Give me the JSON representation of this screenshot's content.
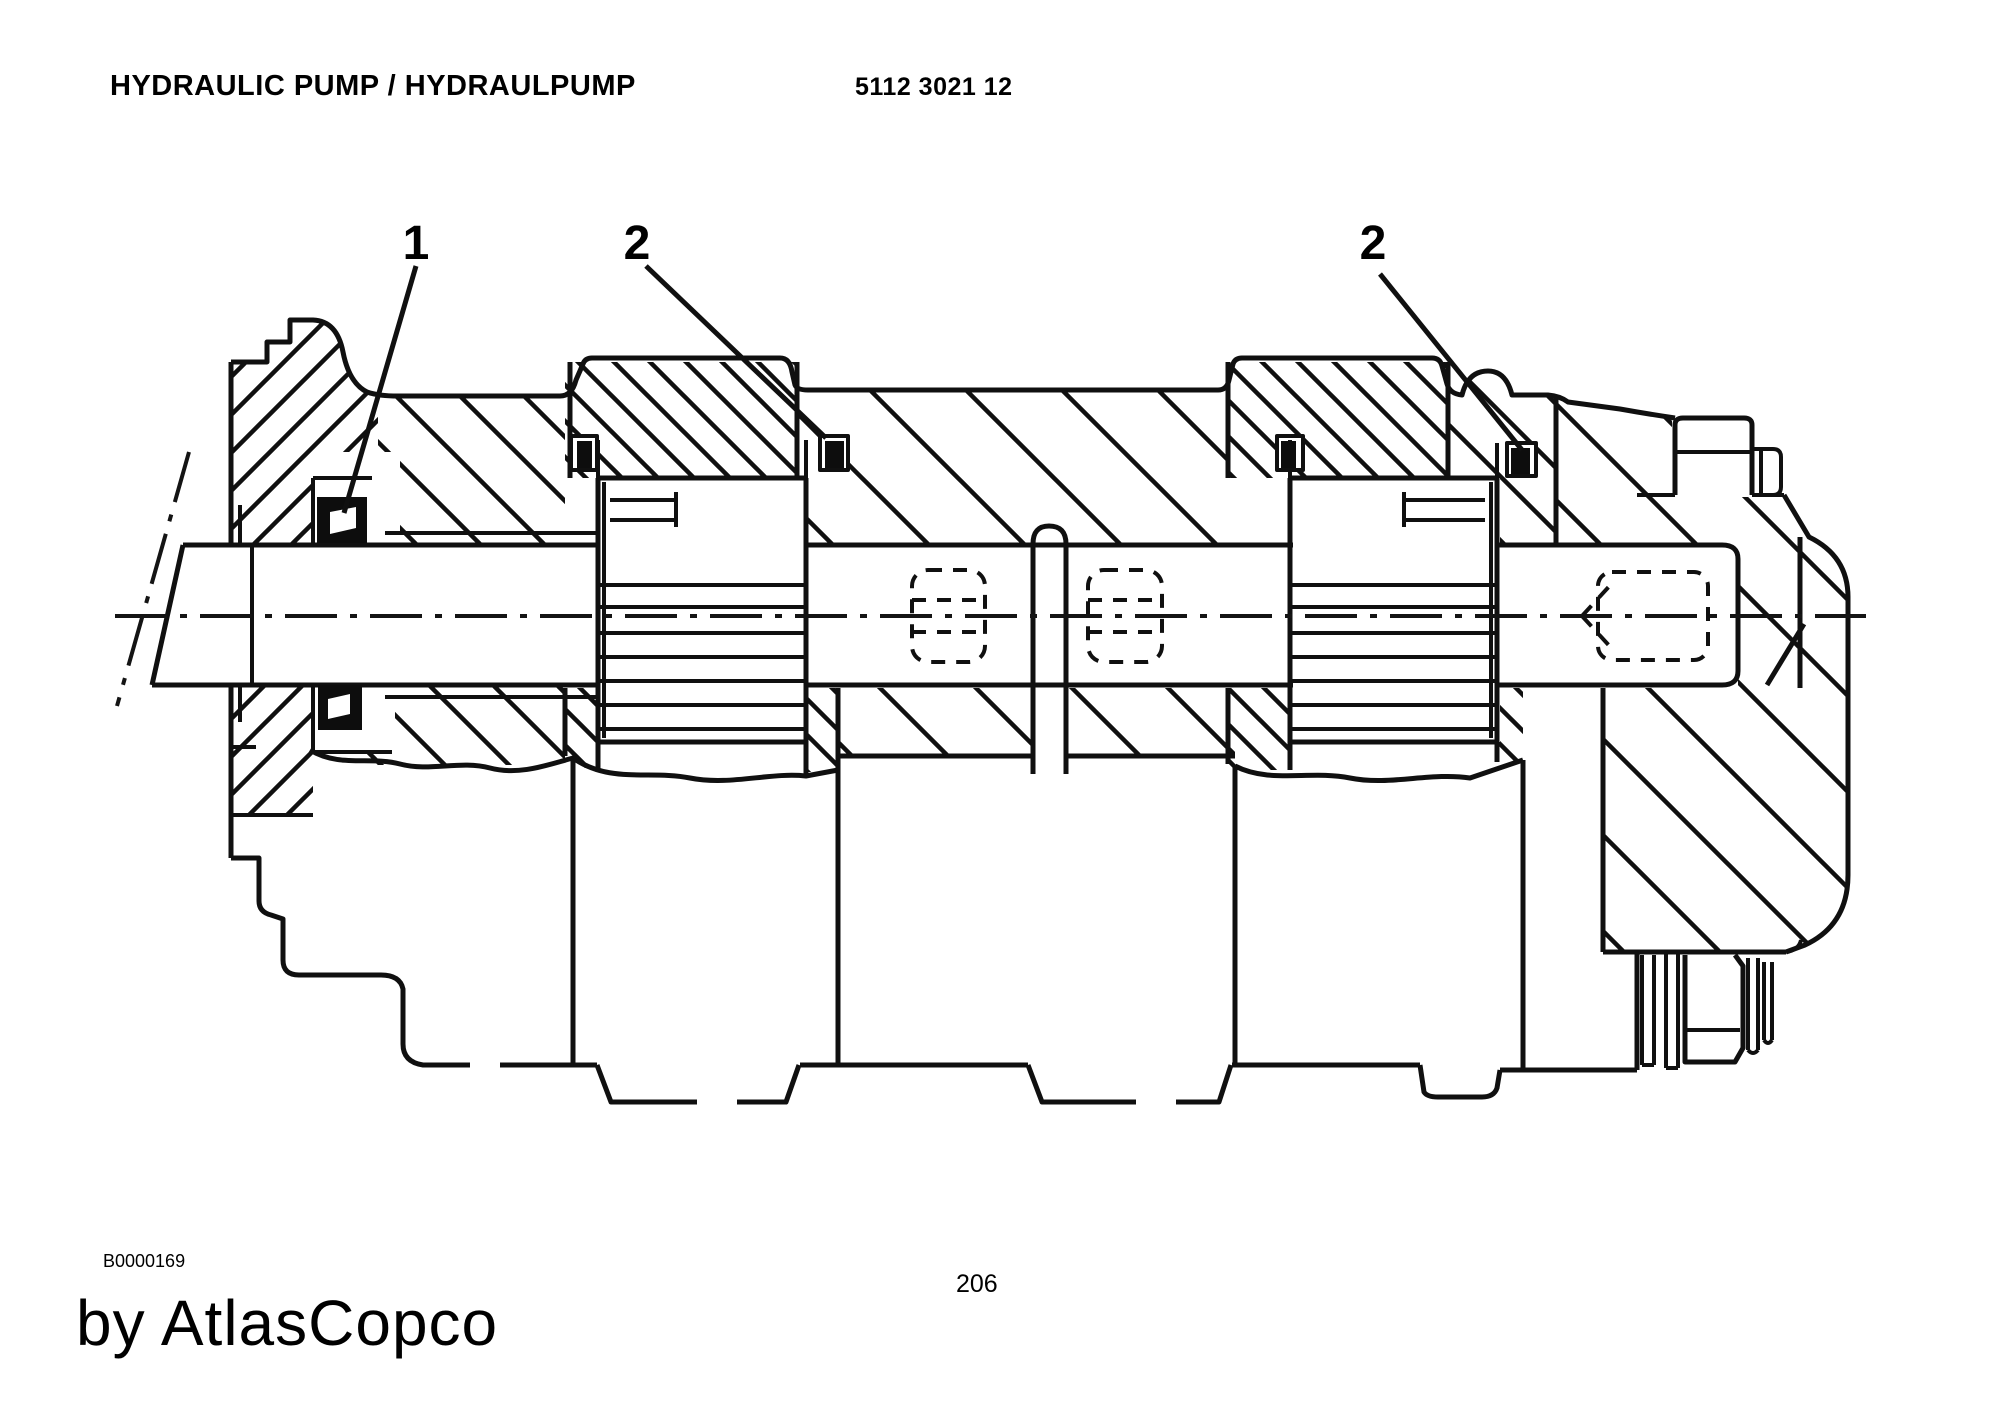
{
  "page": {
    "title": "HYDRAULIC PUMP / HYDRAULPUMP",
    "part_number": "5112 3021 12",
    "figure_code": "B0000169",
    "watermark": "by AtlasCopco",
    "page_number": "206"
  },
  "diagram": {
    "kind": "engineering cross-section drawing",
    "subject": "hydraulic pump",
    "callouts": [
      {
        "label": "1"
      },
      {
        "label": "2"
      },
      {
        "label": "2"
      }
    ],
    "colors": {
      "line": "#101010",
      "background": "#ffffff"
    }
  }
}
